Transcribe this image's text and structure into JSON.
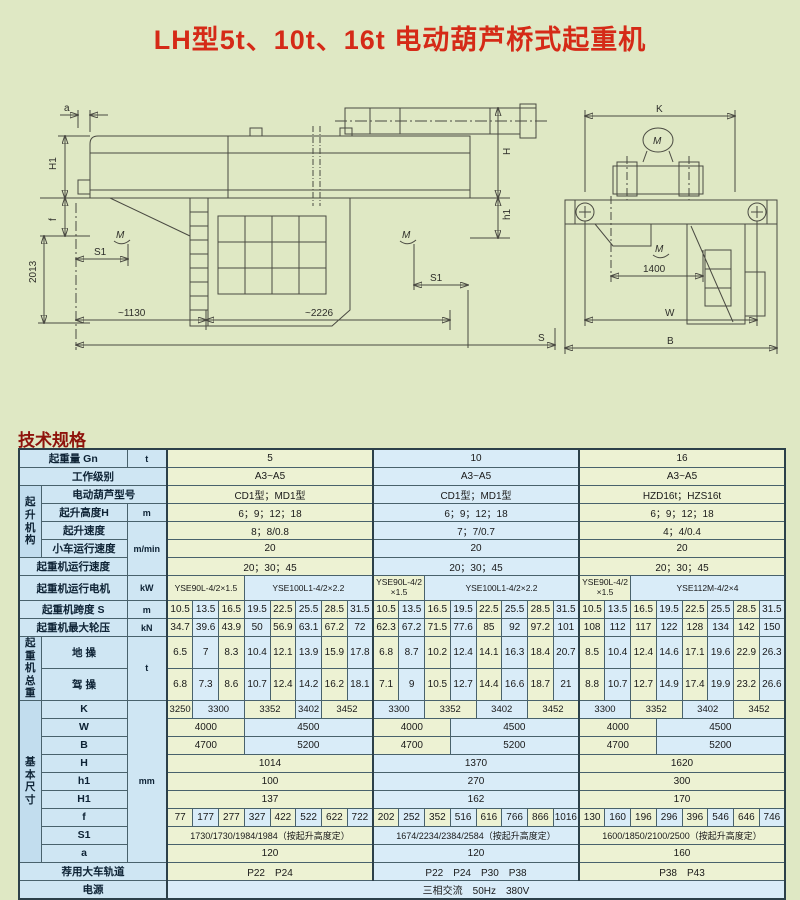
{
  "title": "LH型5t、10t、16t 电动葫芦桥式起重机",
  "section_heading": "技术规格",
  "drawing_left": {
    "a": "a",
    "H1": "H1",
    "f": "f",
    "v2013": "2013",
    "S1_left": "S1",
    "S1_right": "S1",
    "d1130": "~1130",
    "d2226": "~2226",
    "S": "S",
    "H": "H",
    "h1": "h1",
    "m": "M"
  },
  "drawing_right": {
    "K": "K",
    "d1400": "1400",
    "W": "W",
    "B": "B",
    "m": "M"
  },
  "table": {
    "capacity": {
      "label": "起重量 Gn",
      "unit": "t",
      "values": [
        "5",
        "10",
        "16"
      ],
      "spans": [
        8,
        8,
        8
      ]
    },
    "duty": {
      "label": "工作级别",
      "values": [
        "A3~A5",
        "A3~A5",
        "A3~A5"
      ],
      "spans": [
        8,
        8,
        8
      ]
    },
    "hoist_group": {
      "label": "起升\n机构"
    },
    "hoist_model": {
      "label": "电动葫芦型号",
      "values": [
        "CD1型；MD1型",
        "CD1型；MD1型",
        "HZD16t；HZS16t"
      ],
      "spans": [
        8,
        8,
        8
      ]
    },
    "lift_height": {
      "label": "起升高度H",
      "unit": "m",
      "values": [
        "6；9；12；18",
        "6；9；12；18",
        "6；9；12；18"
      ],
      "spans": [
        8,
        8,
        8
      ]
    },
    "lift_speed": {
      "label": "起升速度",
      "unit": "m/min",
      "values": [
        "8；8/0.8",
        "7；7/0.7",
        "4；4/0.4"
      ],
      "spans": [
        8,
        8,
        8
      ]
    },
    "trolley_speed": {
      "label": "小车运行速度",
      "values": [
        "20",
        "20",
        "20"
      ],
      "spans": [
        8,
        8,
        8
      ]
    },
    "crane_speed": {
      "label": "起重机运行速度",
      "values": [
        "20；30；45",
        "20；30；45",
        "20；30；45"
      ],
      "spans": [
        8,
        8,
        8
      ]
    },
    "motor": {
      "label": "起重机运行电机",
      "unit": "kW",
      "m5a": "YSE90L-4/2×1.5",
      "m5b": "YSE100L1-4/2×2.2",
      "m10a": "YSE90L-4/2×1.5",
      "m10b": "YSE100L1-4/2×2.2",
      "m16a": "YSE90L-4/2×1.5",
      "m16b": "YSE112M-4/2×4"
    },
    "span": {
      "label": "起重机跨度 S",
      "unit": "m",
      "v5": [
        "10.5",
        "13.5",
        "16.5",
        "19.5",
        "22.5",
        "25.5",
        "28.5",
        "31.5"
      ],
      "v10": [
        "10.5",
        "13.5",
        "16.5",
        "19.5",
        "22.5",
        "25.5",
        "28.5",
        "31.5"
      ],
      "v16": [
        "10.5",
        "13.5",
        "16.5",
        "19.5",
        "22.5",
        "25.5",
        "28.5",
        "31.5"
      ]
    },
    "wheel_load": {
      "label": "起重机最大轮压",
      "unit": "kN",
      "v5": [
        "34.7",
        "39.6",
        "43.9",
        "50",
        "56.9",
        "63.1",
        "67.2",
        "72"
      ],
      "v10": [
        "62.3",
        "67.2",
        "71.5",
        "77.6",
        "85",
        "92",
        "97.2",
        "101"
      ],
      "v16": [
        "108",
        "112",
        "117",
        "122",
        "128",
        "134",
        "142",
        "150"
      ]
    },
    "weight_group": {
      "label": "起重\n机\n总重",
      "unit": "t"
    },
    "ground_op": {
      "label": "地 操",
      "v5": [
        "6.5",
        "7",
        "8.3",
        "10.4",
        "12.1",
        "13.9",
        "15.9",
        "17.8"
      ],
      "v10": [
        "6.8",
        "8.7",
        "10.2",
        "12.4",
        "14.1",
        "16.3",
        "18.4",
        "20.7"
      ],
      "v16": [
        "8.5",
        "10.4",
        "12.4",
        "14.6",
        "17.1",
        "19.6",
        "22.9",
        "26.3"
      ]
    },
    "cab_op": {
      "label": "驾 操",
      "v5": [
        "6.8",
        "7.3",
        "8.6",
        "10.7",
        "12.4",
        "14.2",
        "16.2",
        "18.1"
      ],
      "v10": [
        "7.1",
        "9",
        "10.5",
        "12.7",
        "14.4",
        "16.6",
        "18.7",
        "21"
      ],
      "v16": [
        "8.8",
        "10.7",
        "12.7",
        "14.9",
        "17.4",
        "19.9",
        "23.2",
        "26.6"
      ]
    },
    "dims_group": {
      "label": "基本\n尺寸",
      "unit": "mm"
    },
    "K": {
      "label": "K",
      "v5": [
        "3250",
        "3300",
        "3352",
        "3402",
        "3452"
      ],
      "s5": [
        1,
        2,
        2,
        1,
        2
      ],
      "v10": [
        "3300",
        "3352",
        "3402",
        "3452"
      ],
      "s10": [
        2,
        2,
        2,
        2
      ],
      "v16": [
        "3300",
        "3352",
        "3402",
        "3452"
      ],
      "s16": [
        2,
        2,
        2,
        2
      ]
    },
    "W": {
      "label": "W",
      "values": [
        "4000",
        "4500",
        "4000",
        "4500",
        "4000",
        "4500"
      ],
      "spans": [
        3,
        5,
        3,
        5,
        3,
        5
      ]
    },
    "B": {
      "label": "B",
      "values": [
        "4700",
        "5200",
        "4700",
        "5200",
        "4700",
        "5200"
      ],
      "spans": [
        3,
        5,
        3,
        5,
        3,
        5
      ]
    },
    "H": {
      "label": "H",
      "values": [
        "1014",
        "1370",
        "1620"
      ],
      "spans": [
        8,
        8,
        8
      ]
    },
    "h1": {
      "label": "h1",
      "values": [
        "100",
        "270",
        "300"
      ],
      "spans": [
        8,
        8,
        8
      ]
    },
    "H1": {
      "label": "H1",
      "values": [
        "137",
        "162",
        "170"
      ],
      "spans": [
        8,
        8,
        8
      ]
    },
    "f": {
      "label": "f",
      "v5": [
        "77",
        "177",
        "277",
        "327",
        "422",
        "522",
        "622",
        "722"
      ],
      "v10": [
        "202",
        "252",
        "352",
        "516",
        "616",
        "766",
        "866",
        "1016"
      ],
      "v16": [
        "130",
        "160",
        "196",
        "296",
        "396",
        "546",
        "646",
        "746"
      ]
    },
    "S1": {
      "label": "S1",
      "values": [
        "1730/1730/1984/1984（按起升高度定）",
        "1674/2234/2384/2584（按起升高度定）",
        "1600/1850/2100/2500（按起升高度定）"
      ],
      "spans": [
        8,
        8,
        8
      ]
    },
    "a": {
      "label": "a",
      "values": [
        "120",
        "120",
        "160"
      ],
      "spans": [
        8,
        8,
        8
      ]
    },
    "rail": {
      "label": "荐用大车轨道",
      "values": [
        "P22　P24",
        "P22　P24　P30　P38",
        "P38　P43"
      ],
      "spans": [
        8,
        8,
        8
      ]
    },
    "power": {
      "label": "电源",
      "value": "三相交流　50Hz　380V"
    }
  }
}
